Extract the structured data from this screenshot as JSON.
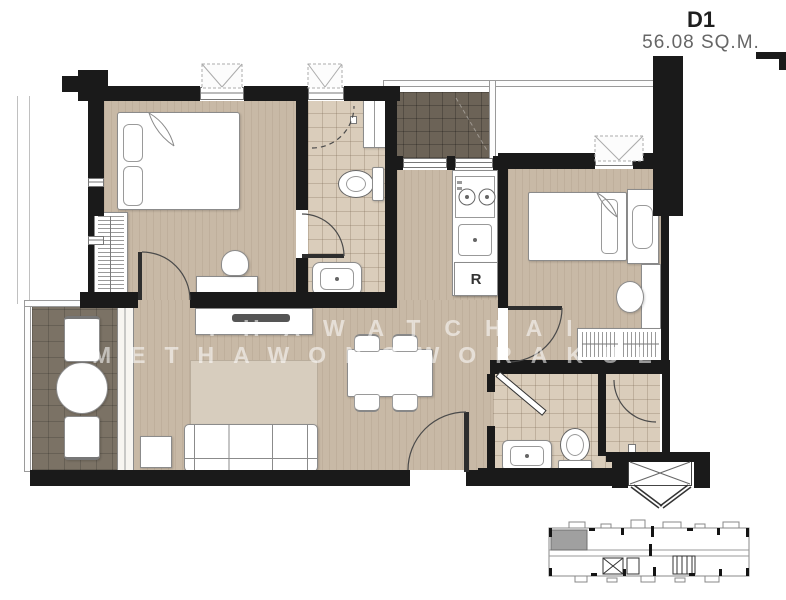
{
  "title": {
    "unit": "D1",
    "area": "56.08 SQ.M."
  },
  "watermark": {
    "line1": "THAWATCHAI",
    "line2": "METHAWONGWORAKUL"
  },
  "labels": {
    "refrigerator": "R"
  },
  "colors": {
    "wall": "#1a1a1a",
    "wood_floor": "#c8b9a6",
    "tile_floor": "#dacdbb",
    "balcony_floor": "#7b7265",
    "terrace_floor": "#6c6357",
    "keyplan_unit_highlight": "#a0a0a0",
    "watermark_text": "rgba(255,255,255,0.55)"
  }
}
